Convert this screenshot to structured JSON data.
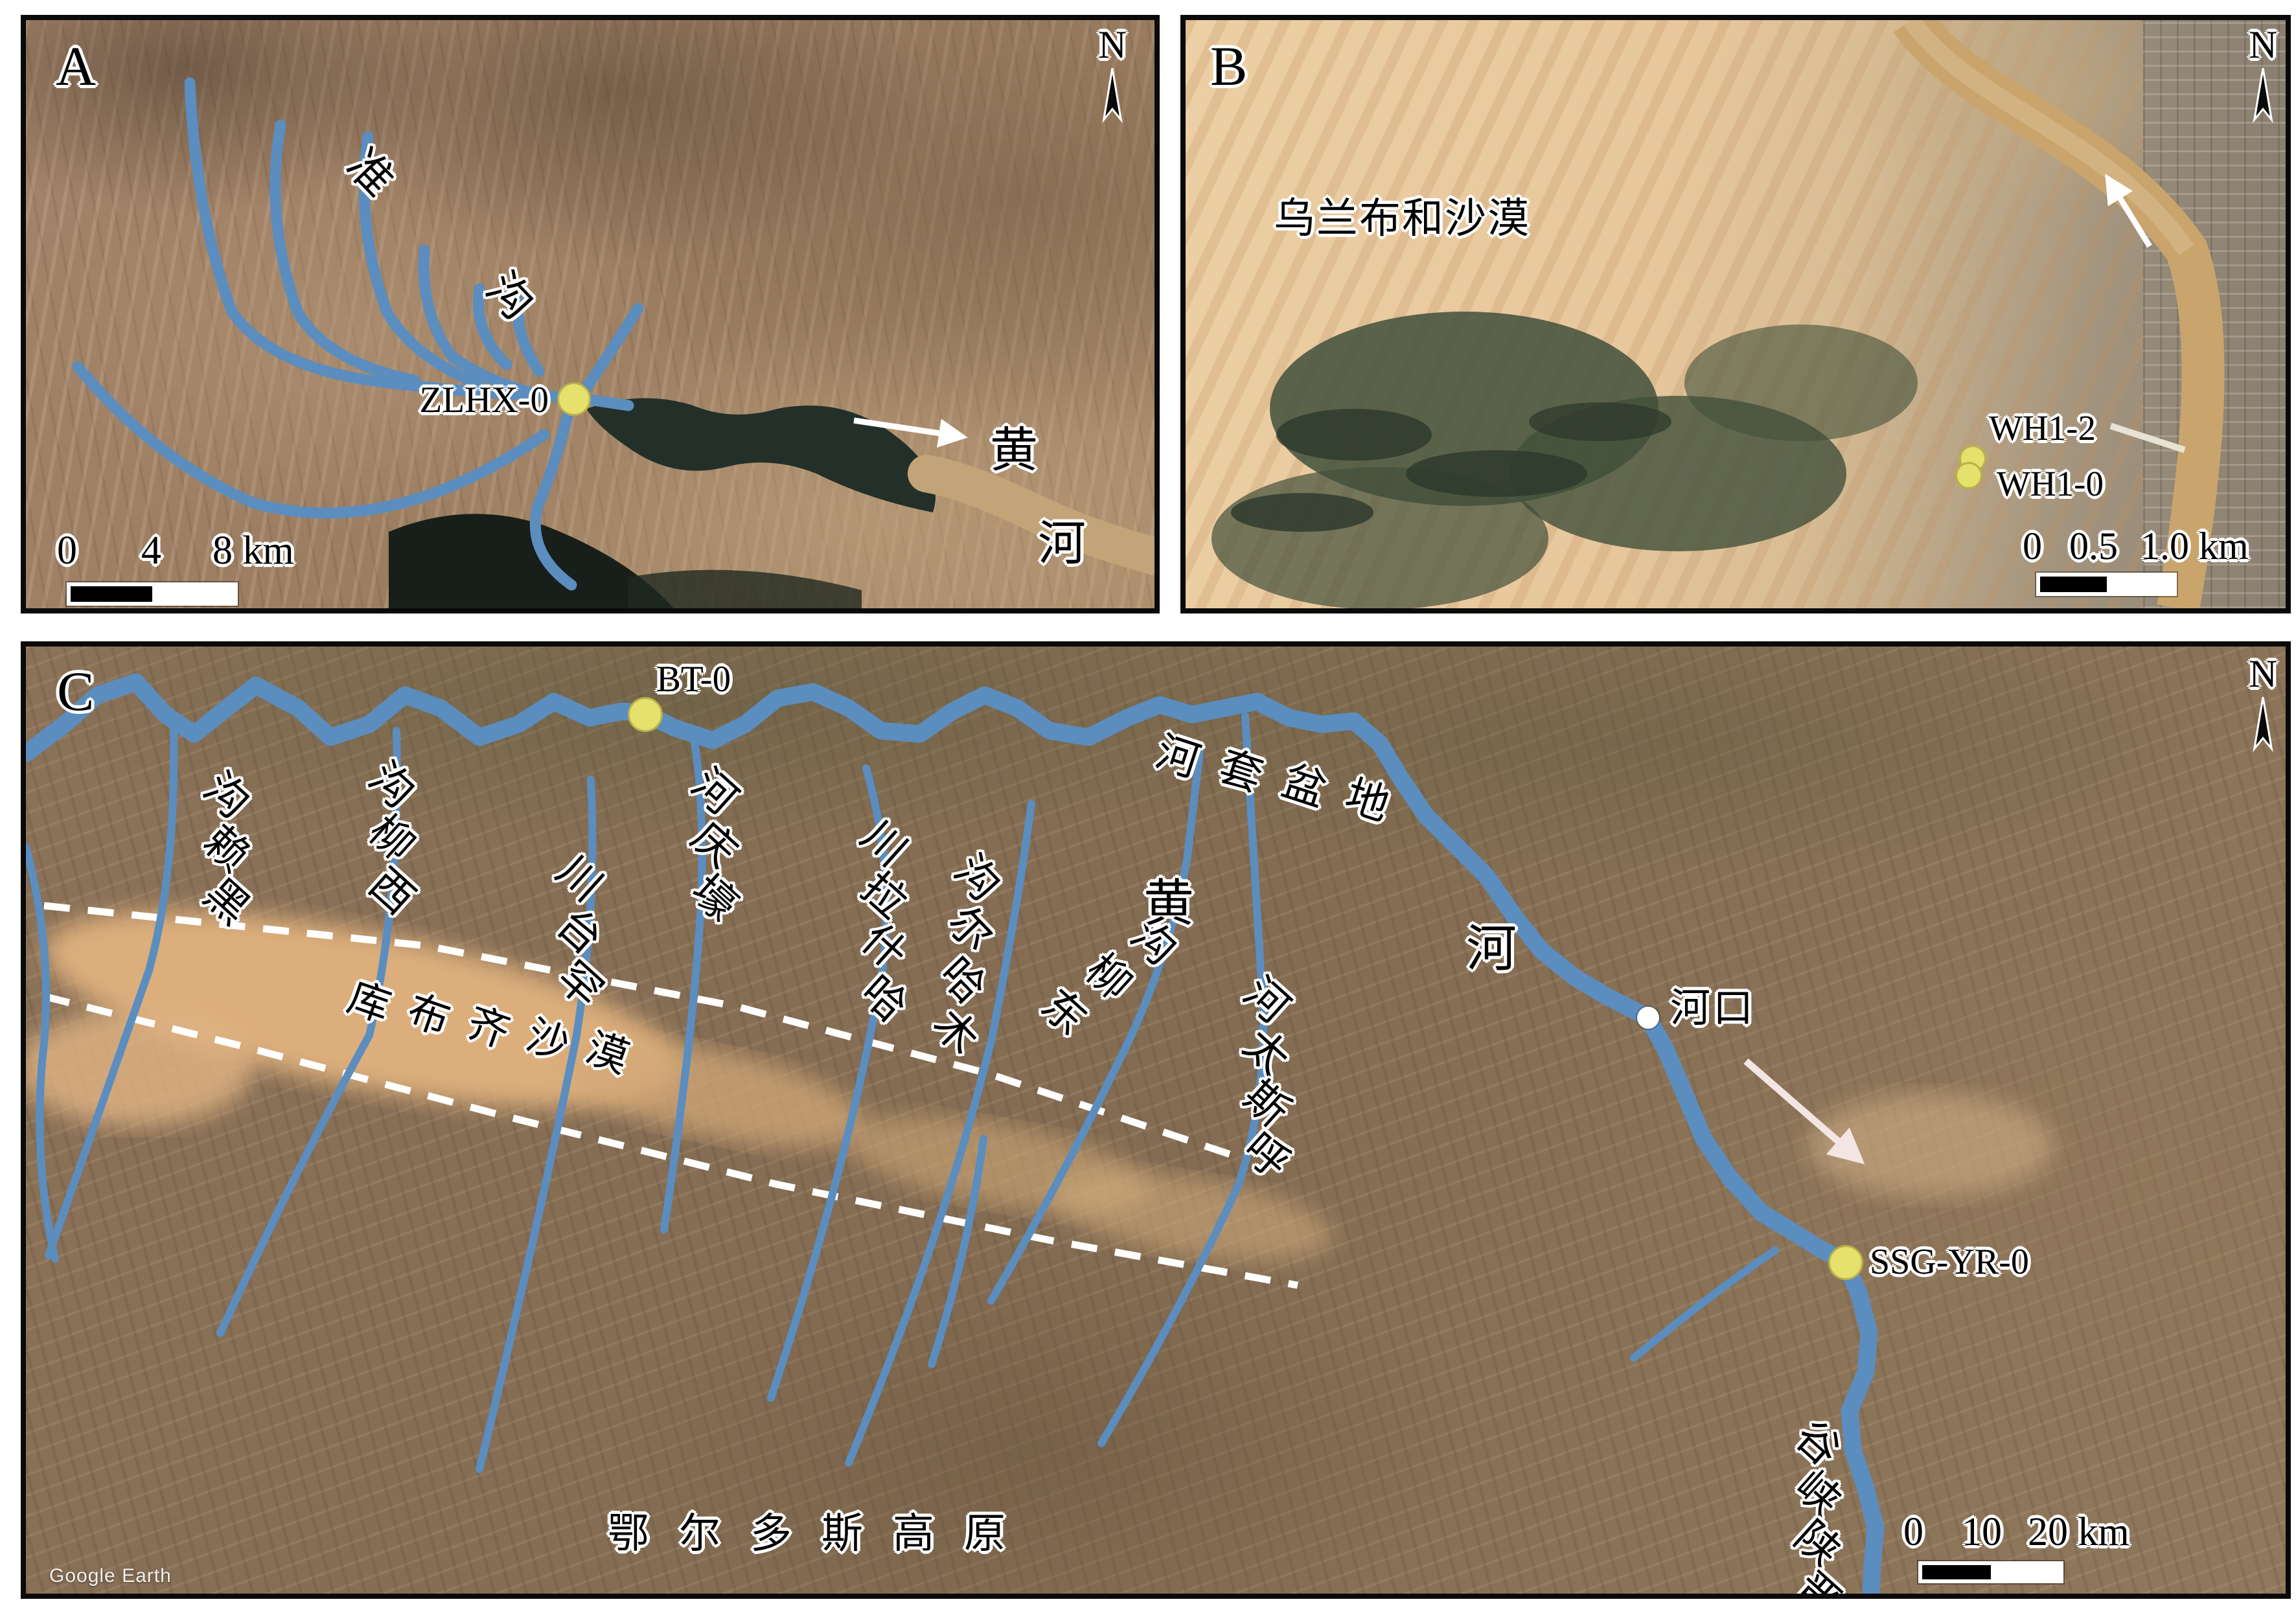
{
  "figure": {
    "colors": {
      "river_blue": "#5b8dbf",
      "site_dot_yellow": "#e6e06c",
      "marker_white": "#ffffff",
      "text_black": "#000000",
      "outline_white": "#ffffff",
      "desert_sand": "#dcae7c"
    },
    "panel_a": {
      "tag": "A",
      "north_label": "N",
      "river_name": "准沟",
      "sample_site": "ZLHX-0",
      "yellow_river": "黄河",
      "scale": {
        "t0": "0",
        "t1": "4",
        "t2": "8 km"
      }
    },
    "panel_b": {
      "tag": "B",
      "north_label": "N",
      "desert": "乌兰布和沙漠",
      "site_upper": "WH1-2",
      "site_lower": "WH1-0",
      "scale": {
        "t0": "0",
        "t1": "0.5",
        "t2": "1.0 km"
      }
    },
    "panel_c": {
      "tag": "C",
      "north_label": "N",
      "site_bt": "BT-0",
      "site_ssg": "SSG-YR-0",
      "hekou": "河口",
      "basin": "河套盆地",
      "kubuqi_desert": "库布齐沙漠",
      "ordos_plateau": "鄂尔多斯高原",
      "jinshaan_gorge": "晋陕峡谷",
      "yellow_river": "黄河",
      "tributaries": [
        "黑赖沟",
        "西柳沟",
        "罕台川",
        "壕庆河",
        "哈什拉川",
        "木哈尔沟",
        "东柳沟",
        "呼斯太河"
      ],
      "scale": {
        "t0": "0",
        "t1": "10",
        "t2": "20 km"
      },
      "watermark": "Google Earth"
    }
  }
}
